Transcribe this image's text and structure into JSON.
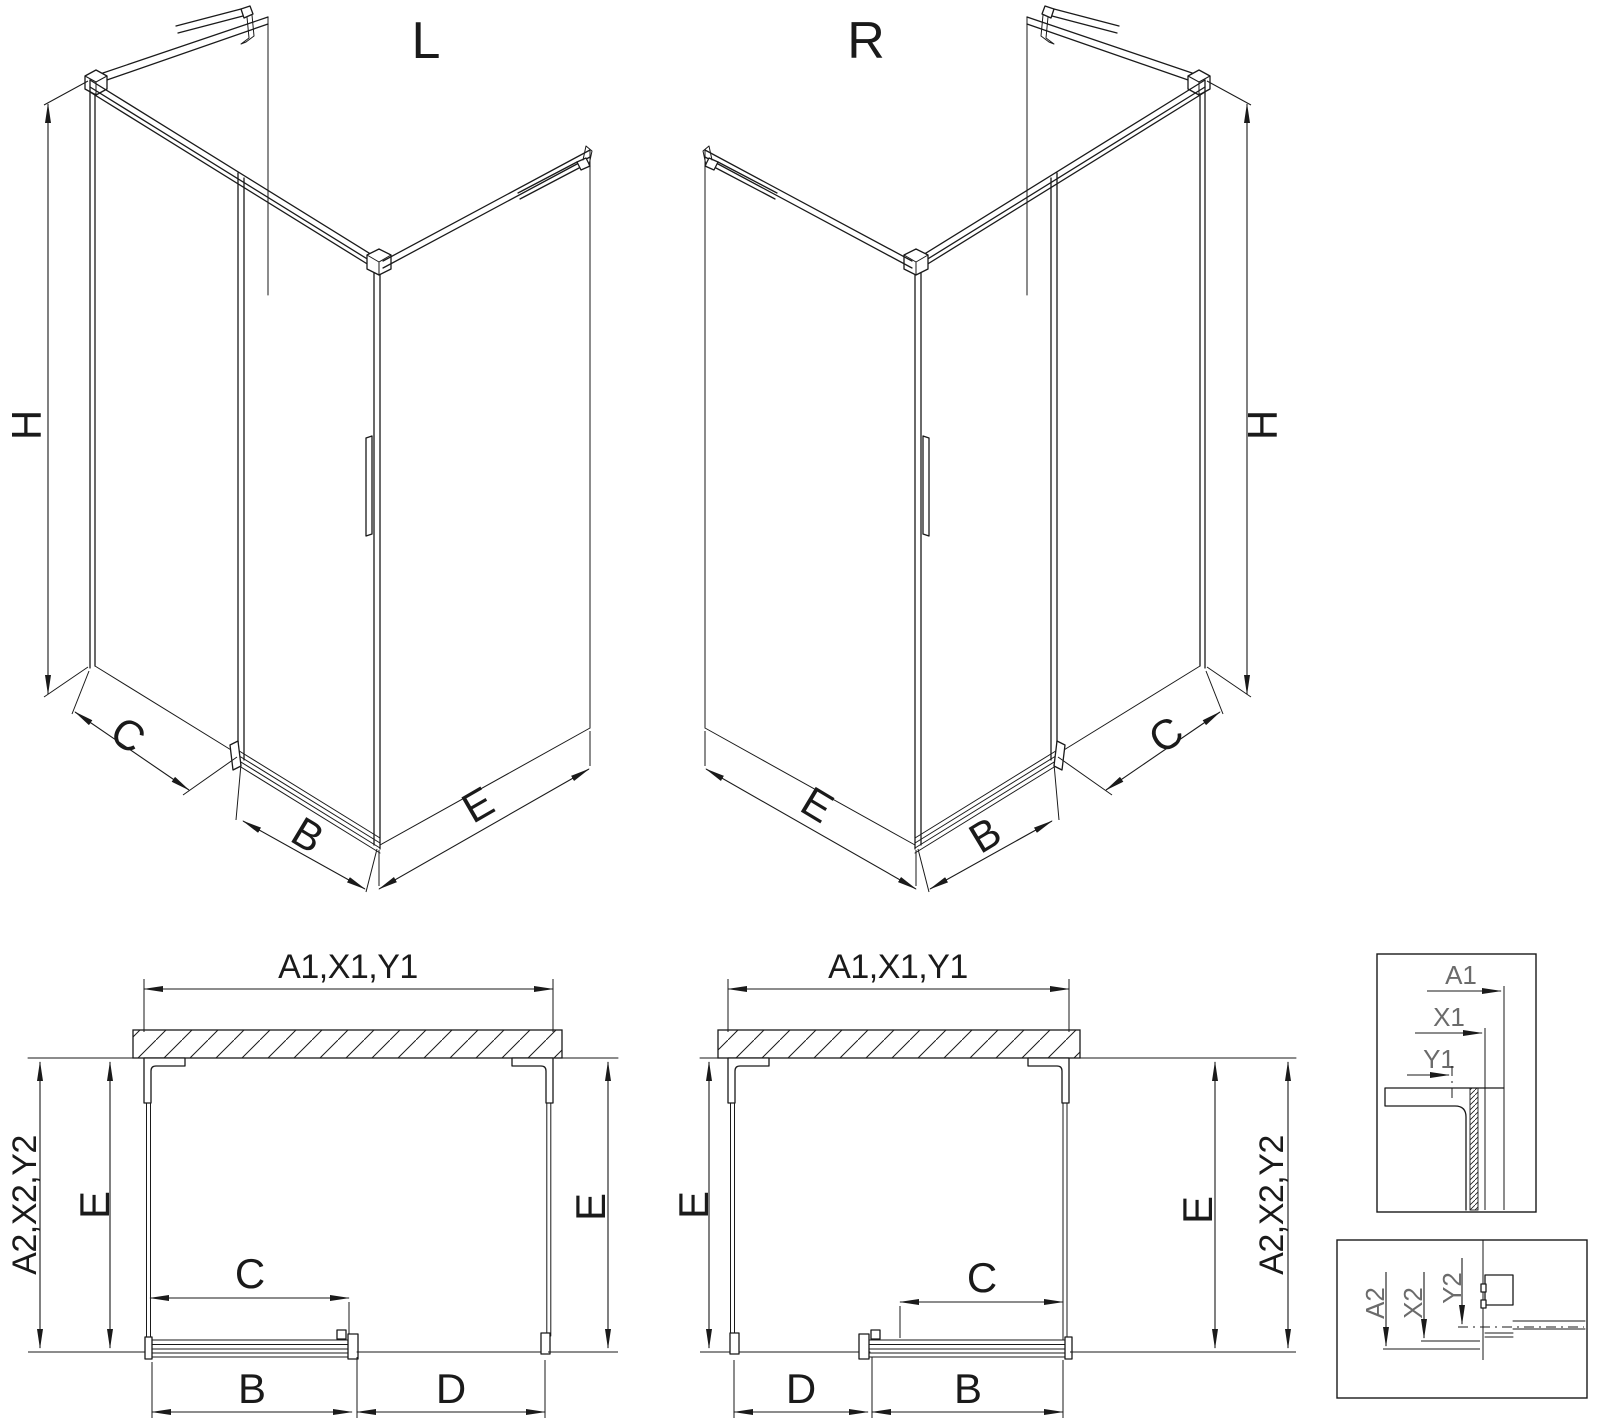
{
  "canvas": {
    "bg": "#ffffff",
    "ink": "#1a1a1a",
    "muted": "#6b6b6b"
  },
  "iso_left": {
    "title": "L",
    "h": "H",
    "c": "C",
    "b": "B",
    "e": "E"
  },
  "iso_right": {
    "title": "R",
    "h": "H",
    "c": "C",
    "b": "B",
    "e": "E"
  },
  "plan_left": {
    "top": "A1,X1,Y1",
    "outer": "A2,X2,Y2",
    "left_e": "E",
    "right_e": "E",
    "c": "C",
    "b": "B",
    "d": "D"
  },
  "plan_right": {
    "top": "A1,X1,Y1",
    "outer": "A2,X2,Y2",
    "left_e": "E",
    "right_e": "E",
    "c": "C",
    "b": "B",
    "d": "D"
  },
  "detail_top": {
    "a1": "A1",
    "x1": "X1",
    "y1": "Y1"
  },
  "detail_bottom": {
    "a2": "A2",
    "x2": "X2",
    "y2": "Y2"
  }
}
